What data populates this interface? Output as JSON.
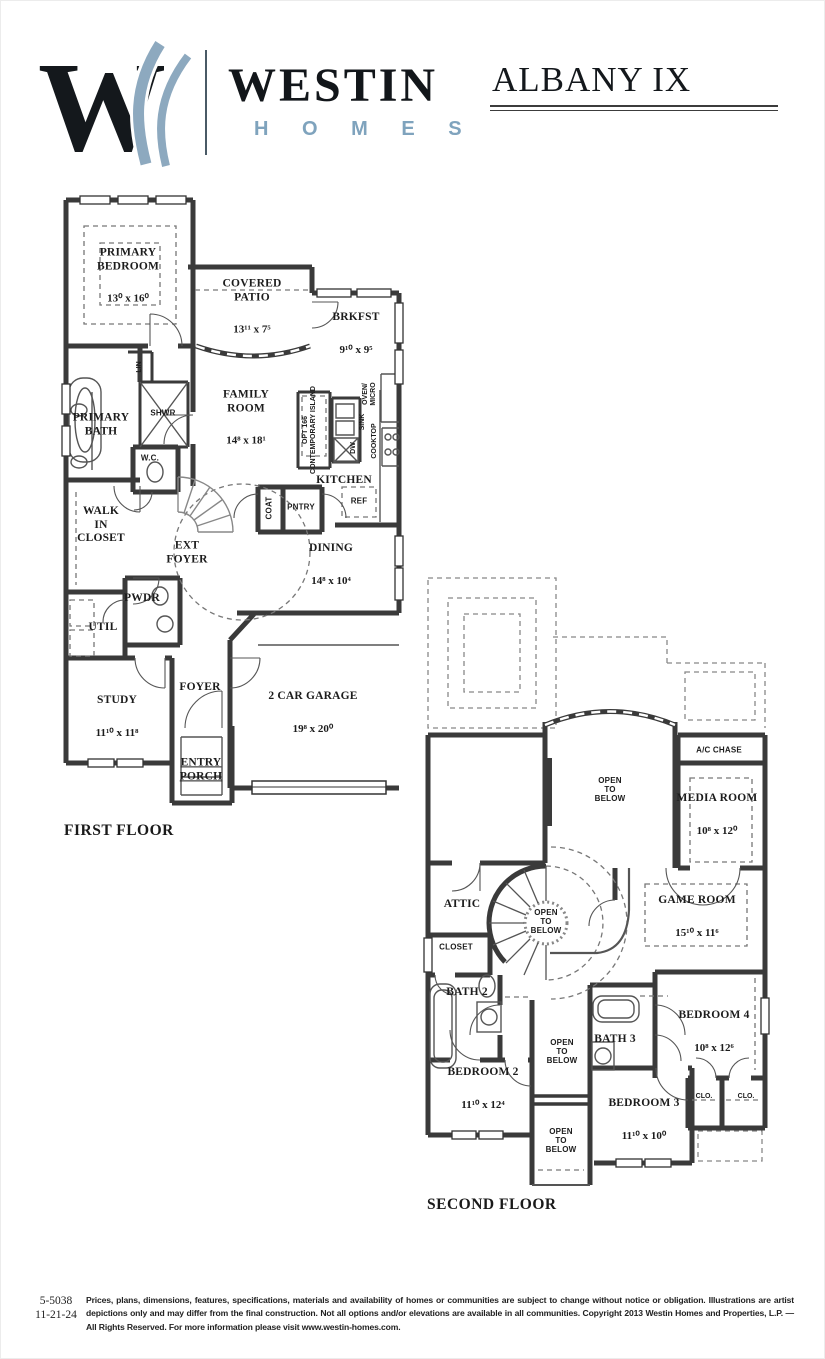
{
  "header": {
    "logo_letter": "W",
    "brand": "WESTIN",
    "brand_sub": "H O M E S",
    "plan_title": "ALBANY IX",
    "colors": {
      "brand_blue": "#7fa3bd",
      "ink": "#14181c"
    }
  },
  "first_floor": {
    "label": "FIRST FLOOR",
    "rooms": {
      "primary_bedroom": {
        "name": "PRIMARY\nBEDROOM",
        "dims": "13⁰ x 16⁰"
      },
      "covered_patio": {
        "name": "COVERED\nPATIO",
        "dims": "13¹¹ x 7⁵"
      },
      "brkfst": {
        "name": "BRKFST",
        "dims": "9¹⁰ x 9⁵"
      },
      "family_room": {
        "name": "FAMILY\nROOM",
        "dims": "14⁸ x 18¹"
      },
      "primary_bath": {
        "name": "PRIMARY\nBATH"
      },
      "walk_in_closet": {
        "name": "WALK\nIN\nCLOSET"
      },
      "ext_foyer": {
        "name": "EXT\nFOYER"
      },
      "pwdr": {
        "name": "PWDR"
      },
      "util": {
        "name": "UTIL"
      },
      "kitchen": {
        "name": "KITCHEN"
      },
      "dining": {
        "name": "DINING",
        "dims": "14⁸ x 10⁴"
      },
      "study": {
        "name": "STUDY",
        "dims": "11¹⁰ x 11⁸"
      },
      "foyer": {
        "name": "FOYER"
      },
      "garage": {
        "name": "2 CAR GARAGE",
        "dims": "19⁸ x 20⁰"
      },
      "entry_porch": {
        "name": "ENTRY\nPORCH"
      },
      "shwr": {
        "name": "SHWR"
      },
      "wc": {
        "name": "W.C."
      },
      "lin": {
        "name": "LIN"
      },
      "pntry": {
        "name": "PNTRY"
      },
      "coat": {
        "name": "COAT"
      },
      "ref": {
        "name": "REF"
      },
      "opt_island": {
        "name": "OPT 166\nCONTEMPORARY ISLAND"
      },
      "dw": {
        "name": "DW"
      },
      "sink": {
        "name": "SINK"
      },
      "oven_micro": {
        "name": "OVEN/\nMICRO"
      },
      "cooktop": {
        "name": "COOKTOP"
      }
    }
  },
  "second_floor": {
    "label": "SECOND FLOOR",
    "rooms": {
      "ac_chase": {
        "name": "A/C CHASE"
      },
      "open_below_top": {
        "name": "OPEN\nTO\nBELOW"
      },
      "media_room": {
        "name": "MEDIA ROOM",
        "dims": "10⁸ x 12⁰"
      },
      "attic": {
        "name": "ATTIC"
      },
      "open_below_stair": {
        "name": "OPEN\nTO\nBELOW"
      },
      "game_room": {
        "name": "GAME ROOM",
        "dims": "15¹⁰ x 11⁶"
      },
      "closet": {
        "name": "CLOSET"
      },
      "bath2": {
        "name": "BATH 2"
      },
      "bedroom4": {
        "name": "BEDROOM 4",
        "dims": "10⁸ x 12⁶"
      },
      "open_below_mid": {
        "name": "OPEN\nTO\nBELOW"
      },
      "bath3": {
        "name": "BATH 3"
      },
      "bedroom2": {
        "name": "BEDROOM 2",
        "dims": "11¹⁰ x 12⁴"
      },
      "bedroom3": {
        "name": "BEDROOM 3",
        "dims": "11¹⁰ x 10⁰"
      },
      "clo_left": {
        "name": "CLO."
      },
      "clo_right": {
        "name": "CLO."
      },
      "open_below_bottom": {
        "name": "OPEN\nTO\nBELOW"
      }
    }
  },
  "footer": {
    "plan_number": "5-5038",
    "date": "11-21-24",
    "disclaimer": "Prices, plans, dimensions, features, specifications, materials and availability of homes or communities are subject to change without notice or obligation.  Illustrations are artist depictions only and may differ from the final construction.  Not all options and/or elevations are available in all communities.  Copyright 2013 Westin Homes and Properties, L.P. — All Rights Reserved.  For more information please visit www.westin-homes.com."
  }
}
